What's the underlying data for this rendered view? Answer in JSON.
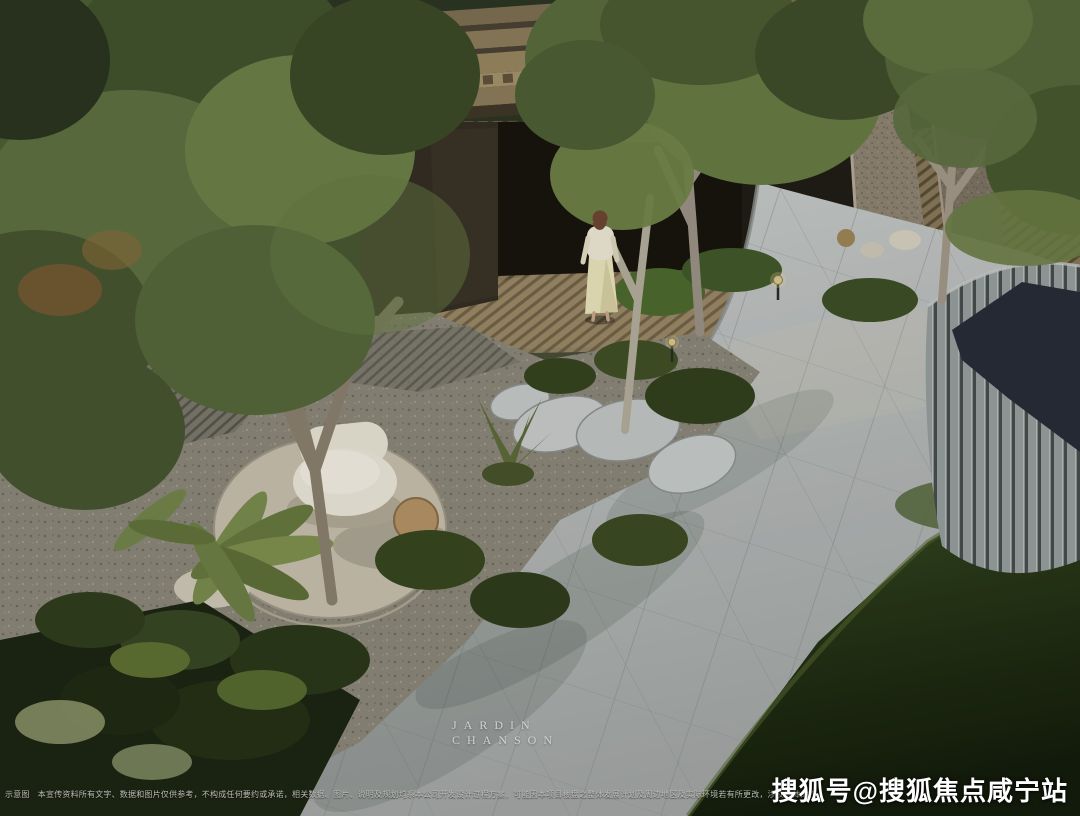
{
  "image": {
    "kind": "landscape-architecture-rendering",
    "description": "Aerial dusk view of a residential courtyard garden: raked gravel beds, a circular concrete seating platform with white pebble poufs, stepping stones, a wide curved stone walkway, a lawn, a curved timber-slat pavilion, trees, and a woman in a pale yellow dress walking toward a passage under a bronze louvered canopy."
  },
  "overlays": {
    "path_label": "JARDIN CHANSON",
    "disclaimer": "示意图　本宣传资料所有文字、数据和图片仅供参考，不构成任何要约或承诺，相关数据、图片、说明及规划均系本公司开发设计过程方案，可能因本项目楼盘之整体发展计划及周边地区及实际环境若有所更改，涉及具体的权利义务，小区规划的配套和最终开发效果的，以政府部门最终批准文件、图示、双方签订的协议为准",
    "watermark": "搜狐号@搜狐焦点咸宁站"
  },
  "palette": {
    "foliage_dark": "#3b4a28",
    "foliage_mid": "#5d7040",
    "foliage_light": "#7c9150",
    "canopy_bronze": "#8d7c5c",
    "passage_dark": "#17140e",
    "stone_column": "#8e8472",
    "striped_paving": "#93805f",
    "gravel": "#8b877a",
    "walkway_light": "#ccd0ce",
    "walkway_shade": "#a4a8a7",
    "platform_beige": "#c8c0ad",
    "pouf_white": "#ece8da",
    "table_wood": "#b59366",
    "lawn_green": "#41542a",
    "pavilion_slat": "#97a09f",
    "pavilion_roof": "#272c38",
    "dress_yellow": "#ebe5bb",
    "watermark_white": "#ffffff"
  }
}
